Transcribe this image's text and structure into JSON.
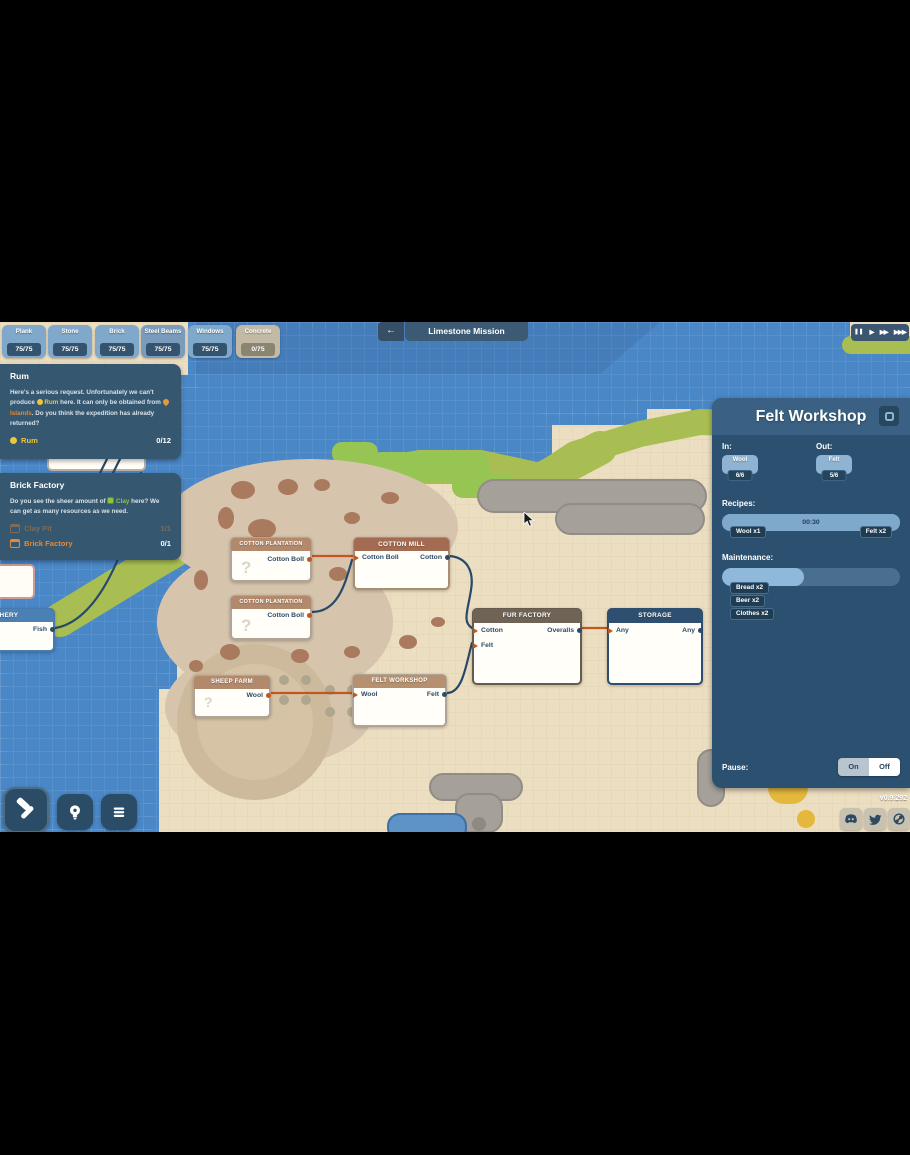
{
  "colors": {
    "water": "#4A87C6",
    "sand": "#ECDEC1",
    "olive_band": "#A9BE52",
    "grass": "#97C554",
    "island": "#D6C4AC",
    "rock": "#A5A19A",
    "accent_orange": "#C2561F",
    "accent_navy": "#27496B",
    "panel_blue": "#2C5170",
    "quest_panel": "#35576F",
    "chip_blue": "#7FA8CA",
    "quest_orange": "#E08A3C",
    "quest_yellow": "#EFC53E",
    "clay_green": "#8CC53F"
  },
  "top_bar": {
    "resources": [
      {
        "name": "Plank",
        "count": "75/75"
      },
      {
        "name": "Stone",
        "count": "75/75"
      },
      {
        "name": "Brick",
        "count": "75/75"
      },
      {
        "name": "Steel Beams",
        "count": "75/75"
      },
      {
        "name": "Windows",
        "count": "75/75"
      },
      {
        "name": "Concrete",
        "count": "0/75"
      }
    ],
    "mission": {
      "back": "←",
      "title": "Limestone Mission"
    },
    "playback": {
      "pause": "❚❚",
      "play": "▶",
      "fast": "▶▶",
      "fastest": "▶▶▶"
    }
  },
  "quests": {
    "rum": {
      "title": "Rum",
      "desc_1": "Here's a serious request. Unfortunately we can't produce",
      "rum_name": "Rum",
      "desc_2": "here. It can only be obtained from",
      "islands_name": "Islands",
      "desc_3": ". Do you think the expedition has already returned?",
      "objective_label": "Rum",
      "objective_progress": "0/12"
    },
    "brick": {
      "title": "Brick Factory",
      "desc_1": "Do you see the sheer amount of",
      "clay_name": "Clay",
      "desc_2": "here? We can get as many resources as we need.",
      "objectives": [
        {
          "label": "Clay Pit",
          "progress": "1/1"
        },
        {
          "label": "Brick Factory",
          "progress": "0/1"
        }
      ]
    }
  },
  "nodes": {
    "question_mark": "?",
    "fishery": {
      "title": "FISHERY",
      "outputs": [
        "Fish"
      ]
    },
    "cotton_plantation_1": {
      "title": "COTTON PLANTATION",
      "outputs": [
        "Cotton Boll"
      ]
    },
    "cotton_plantation_2": {
      "title": "COTTON PLANTATION",
      "outputs": [
        "Cotton Boll"
      ]
    },
    "cotton_mill": {
      "title": "COTTON MILL",
      "inputs": [
        "Cotton Boll"
      ],
      "outputs": [
        "Cotton"
      ]
    },
    "fur_factory": {
      "title": "FUR FACTORY",
      "inputs": [
        "Cotton",
        "Felt"
      ],
      "outputs": [
        "Overalls"
      ]
    },
    "storage": {
      "title": "STORAGE",
      "inputs": [
        "Any"
      ],
      "outputs": [
        "Any"
      ]
    },
    "sheep_farm": {
      "title": "SHEEP FARM",
      "outputs": [
        "Wool"
      ]
    },
    "felt_workshop": {
      "title": "FELT WORKSHOP",
      "inputs": [
        "Wool"
      ],
      "outputs": [
        "Felt"
      ]
    }
  },
  "panel": {
    "title": "Felt Workshop",
    "in_label": "In:",
    "out_label": "Out:",
    "in_chip": {
      "name": "Wool",
      "count": "6/6"
    },
    "out_chip": {
      "name": "Felt",
      "count": "5/6"
    },
    "recipes_label": "Recipes:",
    "recipe": {
      "time": "00:30",
      "input": "Wool x1",
      "output": "Felt x2"
    },
    "maintenance_label": "Maintenance:",
    "maintenance_fill_pct": 46,
    "maintenance_items": [
      "Bread x2",
      "Beer x2",
      "Clothes x2"
    ],
    "pause_label": "Pause:",
    "toggle_on": "On",
    "toggle_off": "Off"
  },
  "footer": {
    "version": "v0.9.292",
    "socials": [
      "discord",
      "twitter",
      "steam"
    ]
  }
}
